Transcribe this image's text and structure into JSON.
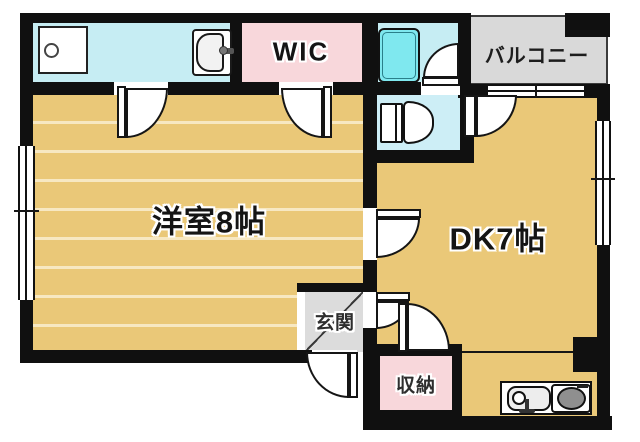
{
  "labels": {
    "western_room": "洋室8帖",
    "dining_kitchen": "DK7帖",
    "walk_in_closet": "WIC",
    "balcony": "バルコニー",
    "entrance": "玄関",
    "storage": "収納"
  },
  "colors": {
    "wall": "#101010",
    "room_floor_tan": "#eac878",
    "wet_area_cyan": "#c6edf3",
    "bathtub_cyan": "#7fe8ef",
    "closet_pink": "#f8d7db",
    "entrance_gray": "#dcdcdc",
    "balcony_gray": "#d9d9d9"
  },
  "icons": {
    "washing_machine": "washing-machine-icon",
    "washbasin": "washbasin-icon",
    "bathtub": "bathtub-icon",
    "toilet": "toilet-icon",
    "kitchen_sink": "kitchen-sink-icon",
    "stove": "stove-icon",
    "door_swing": "door-swing-icon",
    "window": "window-icon"
  }
}
